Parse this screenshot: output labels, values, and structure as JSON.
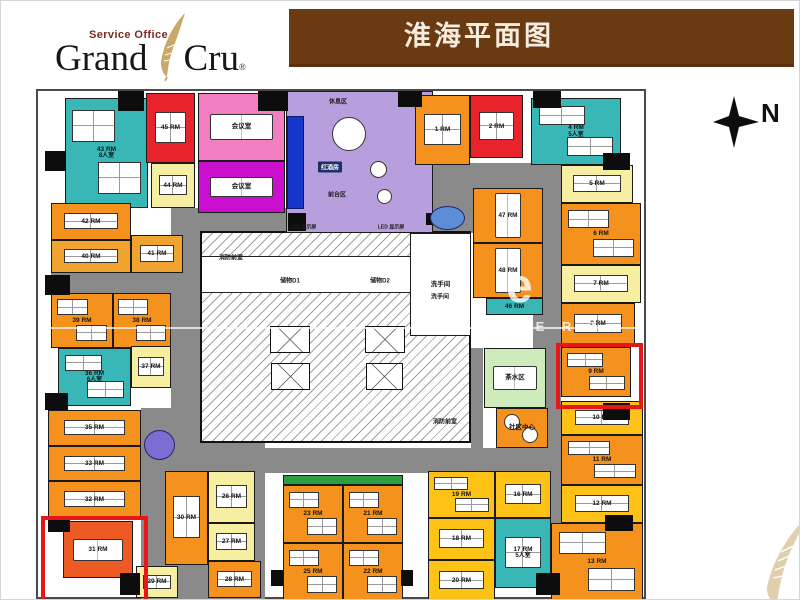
{
  "header": {
    "logo": {
      "tagline": "Service Office",
      "name_left": "Grand",
      "name_right": "Cru",
      "registered": "®"
    },
    "title": "淮海平面图"
  },
  "compass": {
    "label": "N"
  },
  "watermark": {
    "big": "e",
    "letters": "N E X P E R T"
  },
  "plan": {
    "colors": {
      "orange": "#f5921e",
      "darkorange": "#ee5a24",
      "gold": "#f0a32f",
      "yellow": "#fdc215",
      "paleyellow": "#f6efa2",
      "red": "#e8232b",
      "teal": "#39b7b7",
      "pink": "#f07ec0",
      "magenta": "#ca10ce",
      "lavender": "#b79fde",
      "green": "#cdebbb",
      "greenstrip": "#2e9e43",
      "white": "#ffffff"
    },
    "corridors": [
      [
        133,
        117,
        117,
        25
      ],
      [
        13,
        180,
        125,
        22
      ],
      [
        133,
        142,
        42,
        215
      ],
      [
        395,
        72,
        40,
        70
      ],
      [
        435,
        72,
        88,
        25
      ],
      [
        495,
        97,
        28,
        375
      ],
      [
        133,
        357,
        390,
        25
      ],
      [
        103,
        317,
        124,
        193
      ],
      [
        433,
        257,
        12,
        100
      ]
    ],
    "core": {
      "rect": [
        162,
        140,
        271,
        212
      ],
      "band": [
        164,
        165,
        267,
        37
      ],
      "elevators": [
        [
          232,
          235,
          40,
          27
        ],
        [
          233,
          272,
          39,
          27
        ],
        [
          327,
          235,
          40,
          27
        ],
        [
          328,
          272,
          37,
          27
        ]
      ]
    },
    "rooms": [
      {
        "id": "room-43",
        "label": "43 RM",
        "sub": "8人室",
        "color": "teal",
        "rect": [
          27,
          7,
          83,
          110
        ],
        "furn": "desks"
      },
      {
        "id": "room-45",
        "label": "45 RM",
        "color": "red",
        "rect": [
          108,
          2,
          49,
          70
        ],
        "furn": "desks"
      },
      {
        "id": "room-44",
        "label": "44 RM",
        "color": "paleyellow",
        "rect": [
          113,
          72,
          44,
          45
        ],
        "furn": "desks"
      },
      {
        "id": "meeting-room-1",
        "label": "会议室",
        "color": "pink",
        "rect": [
          160,
          2,
          87,
          68
        ],
        "furn": "table"
      },
      {
        "id": "meeting-room-2",
        "label": "会议室",
        "color": "magenta",
        "rect": [
          160,
          70,
          87,
          52
        ],
        "furn": "table"
      },
      {
        "id": "reception-lounge",
        "label": "",
        "color": "lavender",
        "rect": [
          248,
          0,
          147,
          142
        ],
        "furn": "lounge",
        "extras": {
          "screen": [
            0,
            24,
            17,
            93
          ],
          "circles": [
            [
              62,
              42,
              34
            ],
            [
              91,
              77,
              17
            ],
            [
              97,
              104,
              15
            ]
          ]
        }
      },
      {
        "id": "room-1",
        "label": "1 RM",
        "color": "orange",
        "rect": [
          377,
          4,
          55,
          70
        ],
        "furn": "desks"
      },
      {
        "id": "room-2",
        "label": "2 RM",
        "color": "red",
        "rect": [
          432,
          4,
          53,
          63
        ],
        "furn": "desks"
      },
      {
        "id": "room-4",
        "label": "4 RM",
        "sub": "5人室",
        "color": "teal",
        "rect": [
          493,
          7,
          90,
          67
        ],
        "furn": "desks"
      },
      {
        "id": "room-5",
        "label": "5 RM",
        "color": "paleyellow",
        "rect": [
          523,
          74,
          72,
          38
        ],
        "furn": "desks"
      },
      {
        "id": "room-6",
        "label": "6 RM",
        "color": "orange",
        "rect": [
          523,
          112,
          80,
          62
        ],
        "furn": "desks"
      },
      {
        "id": "room-7",
        "label": "7 RM",
        "color": "paleyellow",
        "rect": [
          523,
          174,
          80,
          38
        ],
        "furn": "desks"
      },
      {
        "id": "room-8",
        "label": "8 RM",
        "color": "orange",
        "rect": [
          523,
          212,
          74,
          42
        ],
        "furn": "desks"
      },
      {
        "id": "room-9",
        "label": "9 RM",
        "color": "orange",
        "rect": [
          523,
          256,
          70,
          50
        ],
        "furn": "desks"
      },
      {
        "id": "room-10",
        "label": "10 RM",
        "color": "yellow",
        "rect": [
          523,
          310,
          82,
          34
        ],
        "furn": "desks"
      },
      {
        "id": "room-11",
        "label": "11 RM",
        "color": "orange",
        "rect": [
          523,
          344,
          82,
          50
        ],
        "furn": "desks"
      },
      {
        "id": "room-12",
        "label": "12 RM",
        "color": "yellow",
        "rect": [
          523,
          394,
          82,
          38
        ],
        "furn": "desks"
      },
      {
        "id": "room-13",
        "label": "13 RM",
        "color": "orange",
        "rect": [
          513,
          432,
          92,
          78
        ],
        "furn": "desks"
      },
      {
        "id": "room-47",
        "label": "47 RM",
        "color": "orange",
        "rect": [
          435,
          97,
          70,
          55
        ],
        "furn": "vtable"
      },
      {
        "id": "room-48",
        "label": "48 RM",
        "color": "orange",
        "rect": [
          435,
          152,
          70,
          55
        ],
        "furn": "vtable"
      },
      {
        "id": "room-46",
        "label": "46 RM",
        "color": "teal",
        "rect": [
          448,
          207,
          57,
          17
        ],
        "furn": "none"
      },
      {
        "id": "room-42",
        "label": "42 RM",
        "color": "orange",
        "rect": [
          13,
          112,
          80,
          37
        ],
        "furn": "desks"
      },
      {
        "id": "room-40",
        "label": "40 RM",
        "color": "gold",
        "rect": [
          13,
          149,
          80,
          33
        ],
        "furn": "desks"
      },
      {
        "id": "room-41",
        "label": "41 RM",
        "color": "gold",
        "rect": [
          93,
          144,
          52,
          38
        ],
        "furn": "desks"
      },
      {
        "id": "room-39",
        "label": "39 RM",
        "color": "orange",
        "rect": [
          13,
          202,
          62,
          55
        ],
        "furn": "desks"
      },
      {
        "id": "room-38",
        "label": "38 RM",
        "color": "orange",
        "rect": [
          75,
          202,
          58,
          55
        ],
        "furn": "desks"
      },
      {
        "id": "room-36",
        "label": "36 RM",
        "sub": "6人室",
        "color": "teal",
        "rect": [
          20,
          257,
          73,
          58
        ],
        "furn": "desks"
      },
      {
        "id": "room-37",
        "label": "37 RM",
        "color": "paleyellow",
        "rect": [
          93,
          255,
          40,
          42
        ],
        "furn": "desks"
      },
      {
        "id": "room-35",
        "label": "35 RM",
        "color": "orange",
        "rect": [
          10,
          319,
          93,
          36
        ],
        "furn": "desks"
      },
      {
        "id": "room-33",
        "label": "33 RM",
        "color": "orange",
        "rect": [
          10,
          355,
          93,
          35
        ],
        "furn": "desks"
      },
      {
        "id": "room-32",
        "label": "32 RM",
        "color": "orange",
        "rect": [
          10,
          390,
          93,
          37
        ],
        "furn": "desks"
      },
      {
        "id": "room-31",
        "label": "31 RM",
        "color": "darkorange",
        "rect": [
          25,
          430,
          70,
          57
        ],
        "furn": "table"
      },
      {
        "id": "room-30",
        "label": "30 RM",
        "color": "orange",
        "rect": [
          127,
          380,
          43,
          94
        ],
        "furn": "desks"
      },
      {
        "id": "room-26",
        "label": "26 RM",
        "color": "paleyellow",
        "rect": [
          170,
          380,
          47,
          52
        ],
        "furn": "desks"
      },
      {
        "id": "room-27",
        "label": "27 RM",
        "color": "paleyellow",
        "rect": [
          170,
          432,
          47,
          38
        ],
        "furn": "desks"
      },
      {
        "id": "room-28",
        "label": "28 RM",
        "color": "orange",
        "rect": [
          170,
          470,
          53,
          37
        ],
        "furn": "desks"
      },
      {
        "id": "room-29",
        "label": "29 RM",
        "color": "paleyellow",
        "rect": [
          98,
          475,
          42,
          32
        ],
        "furn": "desks"
      },
      {
        "id": "planter-strip",
        "label": "",
        "color": "greenstrip",
        "rect": [
          245,
          384,
          120,
          10
        ],
        "furn": "none"
      },
      {
        "id": "room-23",
        "label": "23 RM",
        "color": "orange",
        "rect": [
          245,
          394,
          60,
          58
        ],
        "furn": "desks"
      },
      {
        "id": "room-21",
        "label": "21 RM",
        "color": "orange",
        "rect": [
          305,
          394,
          60,
          58
        ],
        "furn": "desks"
      },
      {
        "id": "room-25",
        "label": "25 RM",
        "color": "orange",
        "rect": [
          245,
          452,
          60,
          58
        ],
        "furn": "desks"
      },
      {
        "id": "room-22",
        "label": "22 RM",
        "color": "orange",
        "rect": [
          305,
          452,
          60,
          58
        ],
        "furn": "desks"
      },
      {
        "id": "room-19",
        "label": "19 RM",
        "color": "yellow",
        "rect": [
          390,
          380,
          67,
          47
        ],
        "furn": "desks"
      },
      {
        "id": "room-16",
        "label": "16 RM",
        "color": "yellow",
        "rect": [
          457,
          380,
          56,
          47
        ],
        "furn": "desks"
      },
      {
        "id": "room-18",
        "label": "18 RM",
        "color": "yellow",
        "rect": [
          390,
          427,
          67,
          42
        ],
        "furn": "desks"
      },
      {
        "id": "room-20",
        "label": "20 RM",
        "color": "yellow",
        "rect": [
          390,
          469,
          67,
          41
        ],
        "furn": "desks"
      },
      {
        "id": "room-17",
        "label": "17 RM",
        "sub": "5人室",
        "color": "teal",
        "rect": [
          457,
          427,
          56,
          70
        ],
        "furn": "desks"
      },
      {
        "id": "tea-area",
        "label": "茶水区",
        "color": "green",
        "rect": [
          446,
          257,
          62,
          60
        ],
        "furn": "table"
      },
      {
        "id": "community-center",
        "label": "社区中心",
        "color": "orange",
        "rect": [
          458,
          317,
          52,
          40
        ],
        "furn": "rounds"
      },
      {
        "id": "restroom",
        "label": "洗手间",
        "color": "white",
        "rect": [
          372,
          142,
          61,
          103
        ],
        "furn": "none"
      }
    ],
    "columns": [
      [
        80,
        0,
        26,
        20
      ],
      [
        220,
        0,
        30,
        20
      ],
      [
        360,
        0,
        24,
        16
      ],
      [
        495,
        0,
        28,
        17
      ],
      [
        565,
        62,
        27,
        17
      ],
      [
        7,
        60,
        21,
        20
      ],
      [
        7,
        184,
        25,
        20
      ],
      [
        7,
        302,
        23,
        17
      ],
      [
        10,
        427,
        22,
        14
      ],
      [
        82,
        482,
        20,
        22
      ],
      [
        233,
        479,
        12,
        16
      ],
      [
        363,
        479,
        12,
        16
      ],
      [
        498,
        482,
        24,
        22
      ],
      [
        567,
        424,
        28,
        16
      ],
      [
        565,
        312,
        27,
        17
      ],
      [
        250,
        122,
        18,
        18
      ],
      [
        388,
        122,
        14,
        12
      ]
    ],
    "ovals": [
      {
        "rect": [
          106,
          339,
          29,
          28
        ],
        "color": "#7a6fd0"
      },
      {
        "rect": [
          392,
          115,
          33,
          22
        ],
        "color": "#5b8dd9"
      }
    ],
    "highlights": [
      {
        "rect": [
          3,
          425,
          99,
          84
        ]
      },
      {
        "rect": [
          518,
          252,
          79,
          58
        ]
      }
    ],
    "labels": [
      {
        "text": "休息区",
        "x": 300,
        "y": 10
      },
      {
        "text": "红酒房",
        "x": 292,
        "y": 76,
        "cls": "chip"
      },
      {
        "text": "前台区",
        "x": 299,
        "y": 103
      },
      {
        "text": "LED 显示屏",
        "x": 265,
        "y": 136,
        "size": 5
      },
      {
        "text": "LED 显示屏",
        "x": 353,
        "y": 136,
        "size": 5
      },
      {
        "text": "消防前室",
        "x": 193,
        "y": 166
      },
      {
        "text": "储物D1",
        "x": 252,
        "y": 189
      },
      {
        "text": "储物D2",
        "x": 342,
        "y": 189
      },
      {
        "text": "洗手间",
        "x": 402,
        "y": 205
      },
      {
        "text": "消防前室",
        "x": 407,
        "y": 330
      }
    ]
  }
}
